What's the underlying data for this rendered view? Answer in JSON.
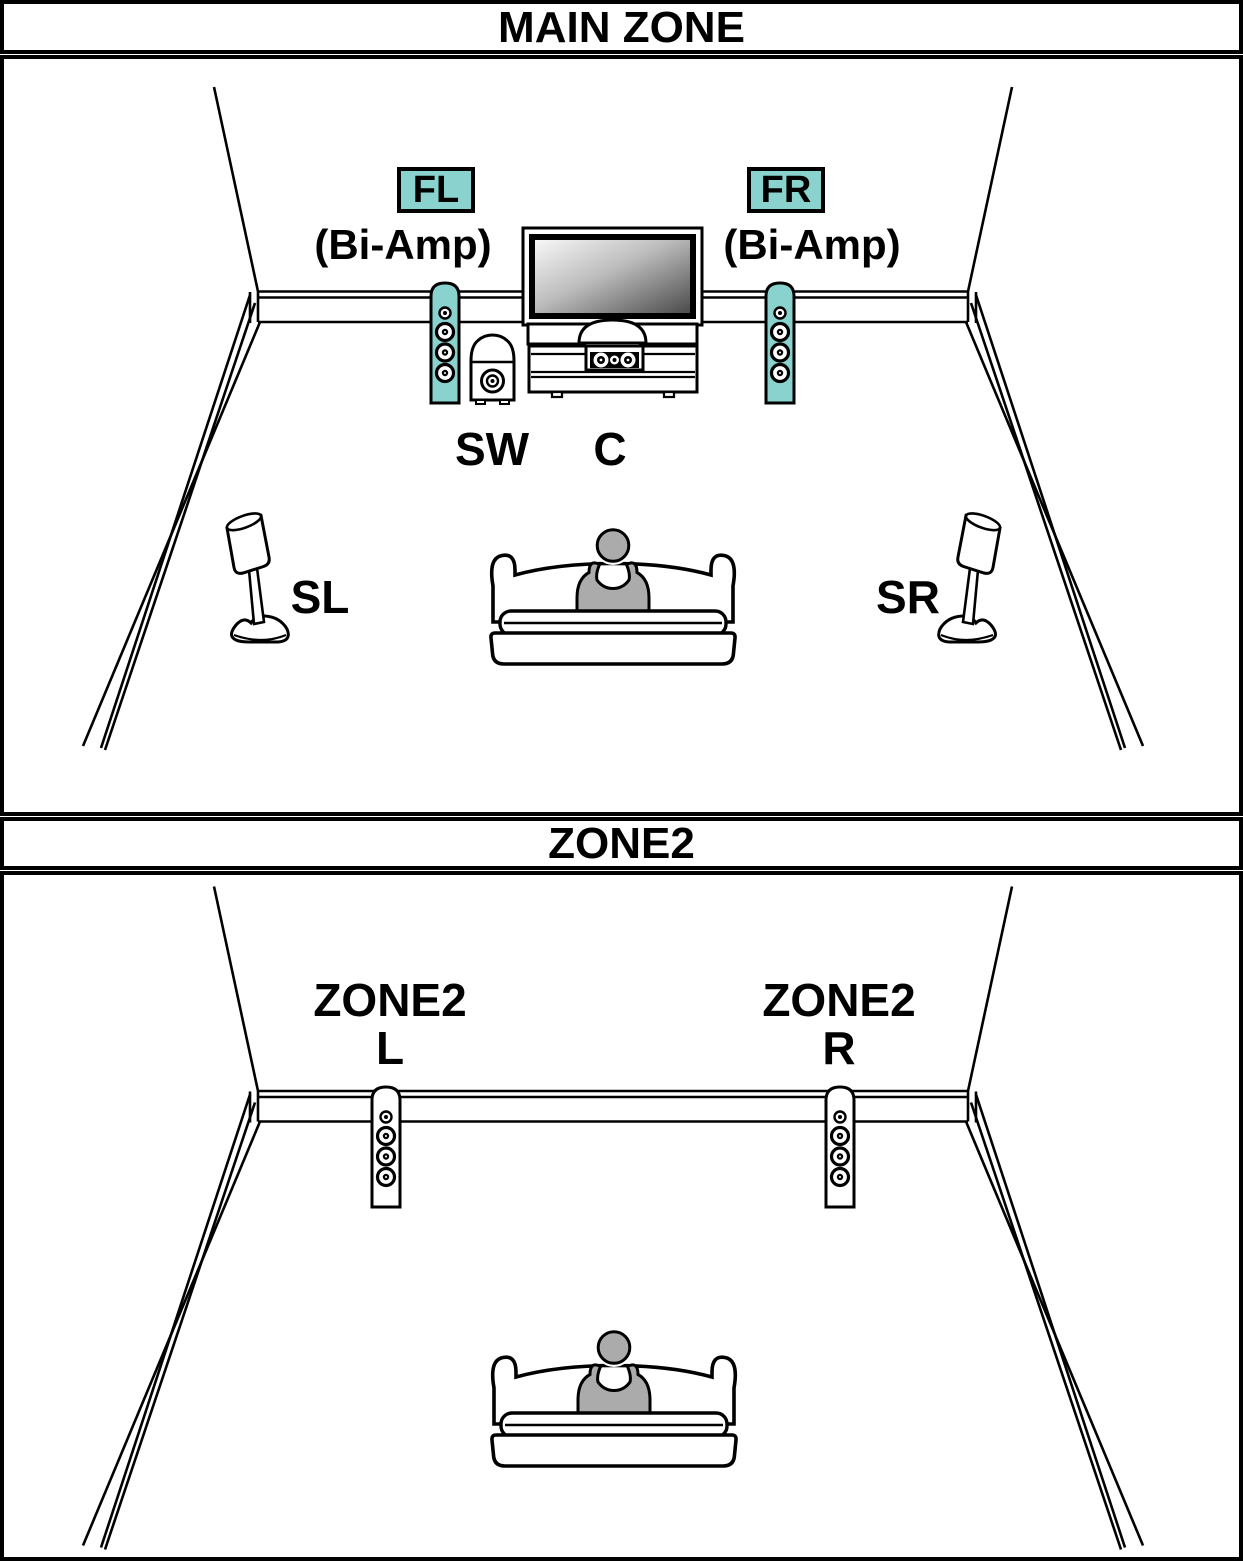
{
  "colors": {
    "background": "#FFFFFF",
    "line_black": "#000000",
    "speaker_highlight_teal": "#89D2CD",
    "speaker_plain_white": "#FFFFFF",
    "person_gray": "#ABABAB"
  },
  "main_zone": {
    "title": "MAIN ZONE",
    "front_left": {
      "badge": "FL",
      "note": "(Bi-Amp)"
    },
    "front_right": {
      "badge": "FR",
      "note": "(Bi-Amp)"
    },
    "subwoofer_label": "SW",
    "center_label": "C",
    "surround_left_label": "SL",
    "surround_right_label": "SR"
  },
  "zone2": {
    "title": "ZONE2",
    "left_speaker": {
      "line1": "ZONE2",
      "line2": "L"
    },
    "right_speaker": {
      "line1": "ZONE2",
      "line2": "R"
    }
  }
}
